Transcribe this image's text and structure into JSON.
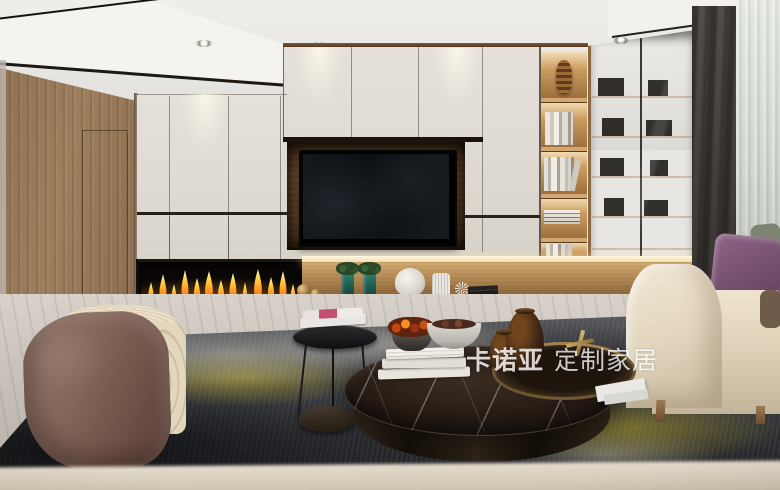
{
  "watermark": {
    "brand": "卡诺亚",
    "suffix": "定制家居"
  },
  "colors": {
    "cabinet-cream": "#dcd7ce",
    "wood-wall": "#9d7f5d",
    "shelf-wood": "#9c6f3d",
    "led-warm": "#f2ddae",
    "flame-yellow": "#ffd23e",
    "flame-orange": "#ff8c1e",
    "pillow-purple": "#8f6488",
    "sofa-beige": "#ddd0b6",
    "rug-dark": "#3c3e42",
    "rug-yellow": "#b7a52b",
    "marble-top": "#241a13",
    "curtain-dark": "#5e5855",
    "sheer-light": "#d3d8d1",
    "watermark-white": "#ffffff"
  }
}
